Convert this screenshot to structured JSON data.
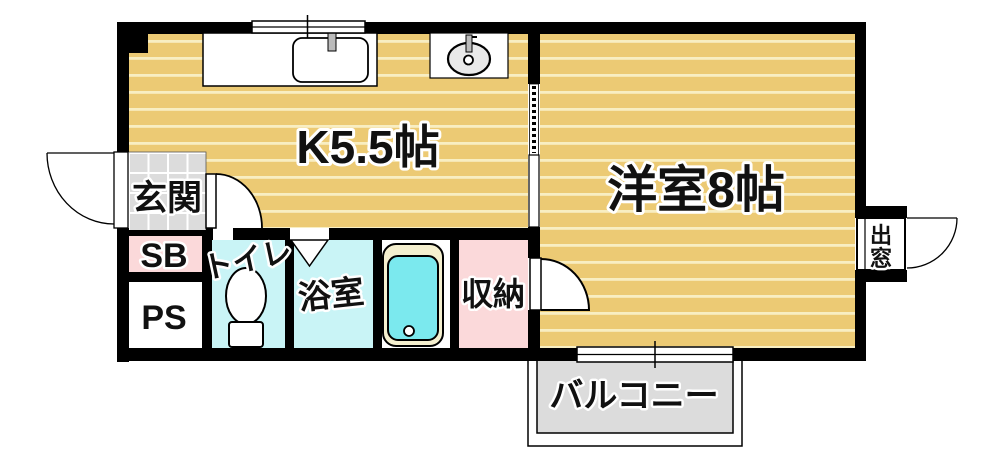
{
  "floorplan": {
    "labels": {
      "kitchen": "K5.5帖",
      "western_room": "洋室8帖",
      "entrance": "玄関",
      "shoe_box": "SB",
      "pipe_space": "PS",
      "toilet": "トイレ",
      "bathroom": "浴室",
      "storage": "収納",
      "balcony": "バルコニー",
      "bay_window_chars": [
        "出",
        "窓"
      ]
    },
    "colors": {
      "floor_tan": "#ecca74",
      "floor_stripe": "#f8eec2",
      "wet_cyan": "#c9f4f6",
      "pink": "#fbd9da",
      "gray": "#dcdcdc",
      "tub_cyan": "#7be9ee",
      "tub_rim": "#f5f0cf",
      "wall": "#000000"
    }
  }
}
